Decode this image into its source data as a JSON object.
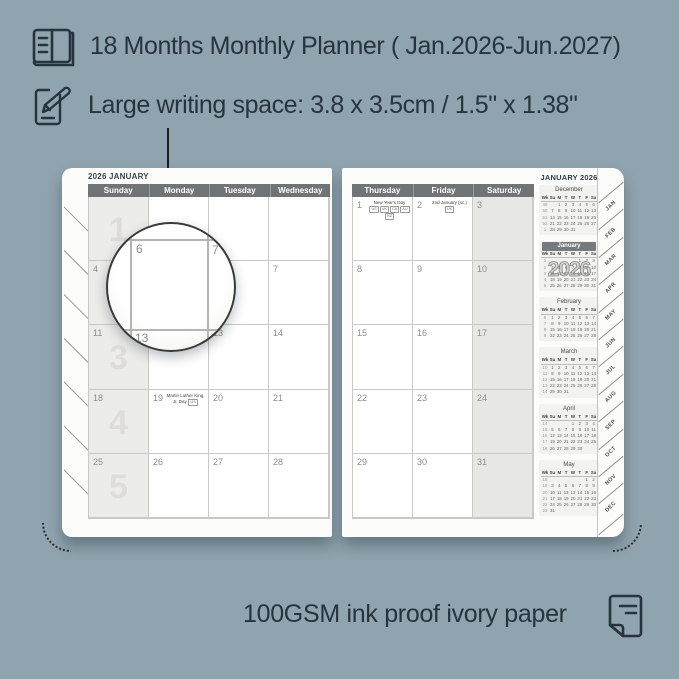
{
  "colors": {
    "background": "#8fa4ae",
    "ink": "#26343d",
    "page": "#fcfcfb",
    "day_header_bar": "#707477",
    "shaded_column": "#ececea",
    "grid_line": "#c9c9c6",
    "date_number": "#8d8d8b",
    "week_number_watermark": "#deddda"
  },
  "header": {
    "line1": "18 Months Monthly Planner ( Jan.2026-Jun.2027)",
    "line2": "Large writing space: 3.8 x 3.5cm / 1.5\" x 1.38\""
  },
  "footer": {
    "text": "100GSM ink proof ivory paper"
  },
  "magnifier": {
    "cell": "6",
    "neighbor": "7",
    "below": "13"
  },
  "planner": {
    "left_page": {
      "title": "2026 JANUARY",
      "day_headers": [
        "Sunday",
        "Monday",
        "Tuesday",
        "Wednesday"
      ],
      "weeks": [
        {
          "week_label": "1",
          "cells": [
            {
              "date": ""
            },
            {
              "date": ""
            },
            {
              "date": ""
            },
            {
              "date": ""
            }
          ]
        },
        {
          "week_label": "2",
          "cells": [
            {
              "date": "4"
            },
            {
              "date": "5"
            },
            {
              "date": "6"
            },
            {
              "date": "7"
            }
          ]
        },
        {
          "week_label": "3",
          "cells": [
            {
              "date": "11"
            },
            {
              "date": "12"
            },
            {
              "date": "13"
            },
            {
              "date": "14"
            }
          ]
        },
        {
          "week_label": "4",
          "cells": [
            {
              "date": "18"
            },
            {
              "date": "19",
              "note": "Martin Luther King, Jr. Day",
              "tags": [
                "US"
              ]
            },
            {
              "date": "20"
            },
            {
              "date": "21"
            }
          ]
        },
        {
          "week_label": "5",
          "cells": [
            {
              "date": "25"
            },
            {
              "date": "26"
            },
            {
              "date": "27"
            },
            {
              "date": "28"
            }
          ]
        }
      ]
    },
    "right_page": {
      "sidebar_title": "JANUARY 2026",
      "day_headers": [
        "Thursday",
        "Friday",
        "Saturday"
      ],
      "weeks": [
        {
          "cells": [
            {
              "date": "1",
              "note": "New Year's Day",
              "tags": [
                "US",
                "UK",
                "CA",
                "AU",
                "NZ"
              ]
            },
            {
              "date": "2",
              "note": "2nd January (sc.)",
              "tags": [
                "UK"
              ]
            },
            {
              "date": "3"
            }
          ]
        },
        {
          "cells": [
            {
              "date": "8"
            },
            {
              "date": "9"
            },
            {
              "date": "10"
            }
          ]
        },
        {
          "cells": [
            {
              "date": "15"
            },
            {
              "date": "16"
            },
            {
              "date": "17"
            }
          ]
        },
        {
          "cells": [
            {
              "date": "22"
            },
            {
              "date": "23"
            },
            {
              "date": "24"
            }
          ]
        },
        {
          "cells": [
            {
              "date": "29"
            },
            {
              "date": "30"
            },
            {
              "date": "31"
            }
          ]
        }
      ]
    },
    "mini_col_headers": [
      "Wk",
      "Su",
      "M",
      "T",
      "W",
      "T",
      "F",
      "Sa"
    ],
    "mini_calendars": [
      {
        "name": "December",
        "highlight": false,
        "rows": [
          [
            "49",
            "",
            "1",
            "2",
            "3",
            "4",
            "5",
            "6"
          ],
          [
            "50",
            "7",
            "8",
            "9",
            "10",
            "11",
            "12",
            "13"
          ],
          [
            "51",
            "14",
            "15",
            "16",
            "17",
            "18",
            "19",
            "20"
          ],
          [
            "52",
            "21",
            "22",
            "23",
            "24",
            "25",
            "26",
            "27"
          ],
          [
            "1",
            "28",
            "29",
            "30",
            "31",
            "",
            "",
            ""
          ]
        ]
      },
      {
        "name": "January",
        "highlight": true,
        "overlay": "2026",
        "rows": [
          [
            "1",
            "",
            "",
            "",
            "",
            "1",
            "2",
            "3"
          ],
          [
            "2",
            "4",
            "5",
            "6",
            "7",
            "8",
            "9",
            "10"
          ],
          [
            "3",
            "11",
            "12",
            "13",
            "14",
            "15",
            "16",
            "17"
          ],
          [
            "4",
            "18",
            "19",
            "20",
            "21",
            "22",
            "23",
            "24"
          ],
          [
            "5",
            "25",
            "26",
            "27",
            "28",
            "29",
            "30",
            "31"
          ]
        ]
      },
      {
        "name": "February",
        "highlight": false,
        "rows": [
          [
            "6",
            "1",
            "2",
            "3",
            "4",
            "5",
            "6",
            "7"
          ],
          [
            "7",
            "8",
            "9",
            "10",
            "11",
            "12",
            "13",
            "14"
          ],
          [
            "8",
            "15",
            "16",
            "17",
            "18",
            "19",
            "20",
            "21"
          ],
          [
            "9",
            "22",
            "23",
            "24",
            "25",
            "26",
            "27",
            "28"
          ]
        ]
      },
      {
        "name": "March",
        "highlight": false,
        "rows": [
          [
            "10",
            "1",
            "2",
            "3",
            "4",
            "5",
            "6",
            "7"
          ],
          [
            "11",
            "8",
            "9",
            "10",
            "11",
            "12",
            "13",
            "14"
          ],
          [
            "12",
            "15",
            "16",
            "17",
            "18",
            "19",
            "20",
            "21"
          ],
          [
            "13",
            "22",
            "23",
            "24",
            "25",
            "26",
            "27",
            "28"
          ],
          [
            "14",
            "29",
            "30",
            "31",
            "",
            "",
            "",
            ""
          ]
        ]
      },
      {
        "name": "April",
        "highlight": false,
        "rows": [
          [
            "14",
            "",
            "",
            "",
            "1",
            "2",
            "3",
            "4"
          ],
          [
            "15",
            "5",
            "6",
            "7",
            "8",
            "9",
            "10",
            "11"
          ],
          [
            "16",
            "12",
            "13",
            "14",
            "15",
            "16",
            "17",
            "18"
          ],
          [
            "17",
            "19",
            "20",
            "21",
            "22",
            "23",
            "24",
            "25"
          ],
          [
            "18",
            "26",
            "27",
            "28",
            "29",
            "30",
            "",
            ""
          ]
        ]
      },
      {
        "name": "May",
        "highlight": false,
        "rows": [
          [
            "18",
            "",
            "",
            "",
            "",
            "",
            "1",
            "2"
          ],
          [
            "19",
            "3",
            "4",
            "5",
            "6",
            "7",
            "8",
            "9"
          ],
          [
            "20",
            "10",
            "11",
            "12",
            "13",
            "14",
            "15",
            "16"
          ],
          [
            "21",
            "17",
            "18",
            "19",
            "20",
            "21",
            "22",
            "23"
          ],
          [
            "22",
            "24",
            "25",
            "26",
            "27",
            "28",
            "29",
            "30"
          ],
          [
            "23",
            "31",
            "",
            "",
            "",
            "",
            "",
            ""
          ]
        ]
      }
    ],
    "tabs": [
      "JAN",
      "FEB",
      "MAR",
      "APR",
      "MAY",
      "JUN",
      "JUL",
      "AUG",
      "SEP",
      "OCT",
      "NOV",
      "DEC"
    ]
  }
}
